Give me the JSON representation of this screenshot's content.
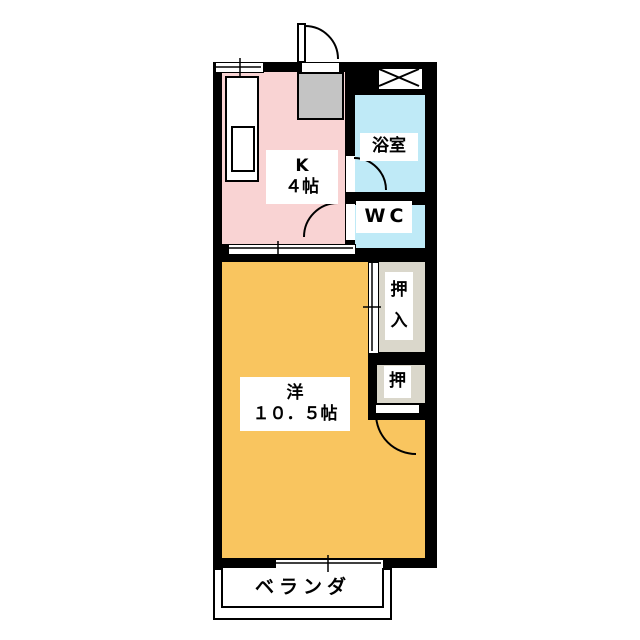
{
  "title": "apartment-floor-plan",
  "rooms": {
    "kitchen": {
      "label": "K",
      "size": "４帖",
      "color": "#f9d3d3"
    },
    "bathroom": {
      "label": "浴室",
      "color": "#bfeaf7"
    },
    "wc": {
      "label": "WC",
      "color": "#bfeaf7"
    },
    "closet_large": {
      "label": "押入",
      "color": "#dad7cb"
    },
    "closet_small": {
      "label": "押",
      "color": "#dad7cb"
    },
    "western": {
      "label": "洋",
      "size": "１０．５帖",
      "color": "#f9c55f"
    },
    "veranda": {
      "label": "ベランダ"
    }
  },
  "areas": {
    "genkan": {
      "color": "#c4c4c4"
    }
  },
  "colors": {
    "wall": "#000000",
    "background": "#ffffff",
    "fixture": "#ffffff"
  },
  "symbols": {
    "entry_door": "hinged-door-arc",
    "bath_door": "hinged-door-arc",
    "wc_door": "hinged-door-arc",
    "closet_door": "hinged-door-arc",
    "kitchen_divider": "sliding-door",
    "closet_front": "sliding-door",
    "balcony_window": "sliding-window",
    "top_left": "window",
    "top_right": "crossed-box"
  }
}
